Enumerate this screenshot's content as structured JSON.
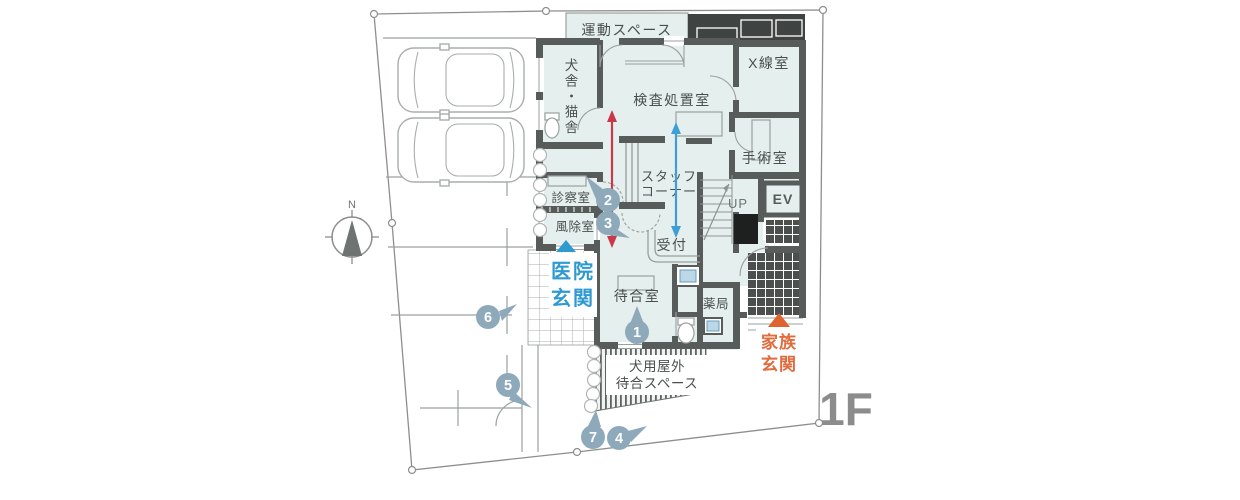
{
  "floor": {
    "label": "1F"
  },
  "compass": {
    "north_label": "N"
  },
  "rooms": {
    "exercise": "運動スペース",
    "kennel": "犬舎・猫舎",
    "exam": "検査処置室",
    "xray": "X線室",
    "surgery": "手術室",
    "staff1": "スタッフ",
    "staff2": "コーナー",
    "consult": "診察室",
    "windbreak": "風除室",
    "reception": "受付",
    "waiting": "待合室",
    "pharmacy": "薬局",
    "up": "UP",
    "ev": "EV"
  },
  "entrances": {
    "clinic1": "医院",
    "clinic2": "玄関",
    "family1": "家族",
    "family2": "玄関"
  },
  "outdoor": {
    "dog1": "犬用屋外",
    "dog2": "待合スペース"
  },
  "route_markers": [
    {
      "number": "1"
    },
    {
      "number": "2"
    },
    {
      "number": "3"
    },
    {
      "number": "4"
    },
    {
      "number": "5"
    },
    {
      "number": "6"
    },
    {
      "number": "7"
    }
  ],
  "colors": {
    "room_fill": "#e5efed",
    "wall": "#575c5b",
    "clinic_entrance_blue": "#2e9ad2",
    "family_entrance_orange": "#e06c3e",
    "route_red": "#c8394b",
    "route_blue": "#3f9fd4",
    "marker_badge": "#8da9ba",
    "floor_label_gray": "#8c8c8c"
  }
}
